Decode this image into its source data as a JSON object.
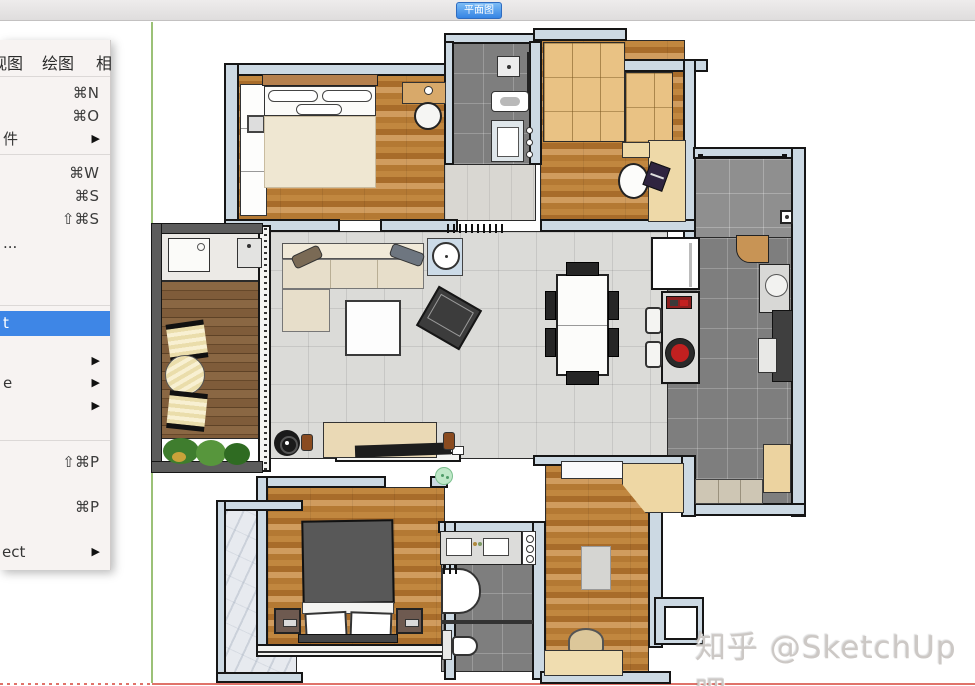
{
  "app": {
    "tab_label": "平面图"
  },
  "menubar": {
    "items": [
      {
        "label": "视图"
      },
      {
        "label": "绘图"
      },
      {
        "label": "相"
      }
    ]
  },
  "menu": {
    "submenu_arrow": "▶",
    "items": [
      {
        "id": "new",
        "shortcut": "⌘N"
      },
      {
        "id": "open",
        "shortcut": "⌘O"
      },
      {
        "id": "open-recent",
        "label_fragment": "件",
        "submenu": true
      },
      {
        "id": "close",
        "shortcut": "⌘W"
      },
      {
        "id": "save",
        "shortcut": "⌘S"
      },
      {
        "id": "save-as",
        "shortcut": "⇧⌘S"
      },
      {
        "id": "save-template",
        "label_fragment": "..."
      },
      {
        "id": "highlighted-item",
        "label_fragment": "t",
        "highlighted": true
      },
      {
        "id": "submenu-a",
        "label_fragment": "",
        "submenu": true
      },
      {
        "id": "submenu-b",
        "label_fragment": "e",
        "submenu": true
      },
      {
        "id": "submenu-c",
        "label_fragment": "",
        "submenu": true
      },
      {
        "id": "page-setup",
        "shortcut": "⇧⌘P"
      },
      {
        "id": "print",
        "shortcut": "⌘P"
      },
      {
        "id": "connect",
        "label_fragment": "ect",
        "submenu": true
      }
    ]
  },
  "watermark": {
    "text": "知乎 @SketchUp吧"
  },
  "colors": {
    "menu_highlight": "#3e86e6",
    "tab_blue": "#3584e4",
    "wall_fill": "#ccd9e3",
    "axis_green": "#9bc177",
    "axis_red": "#e0736a",
    "appliance_red": "#c12020"
  }
}
